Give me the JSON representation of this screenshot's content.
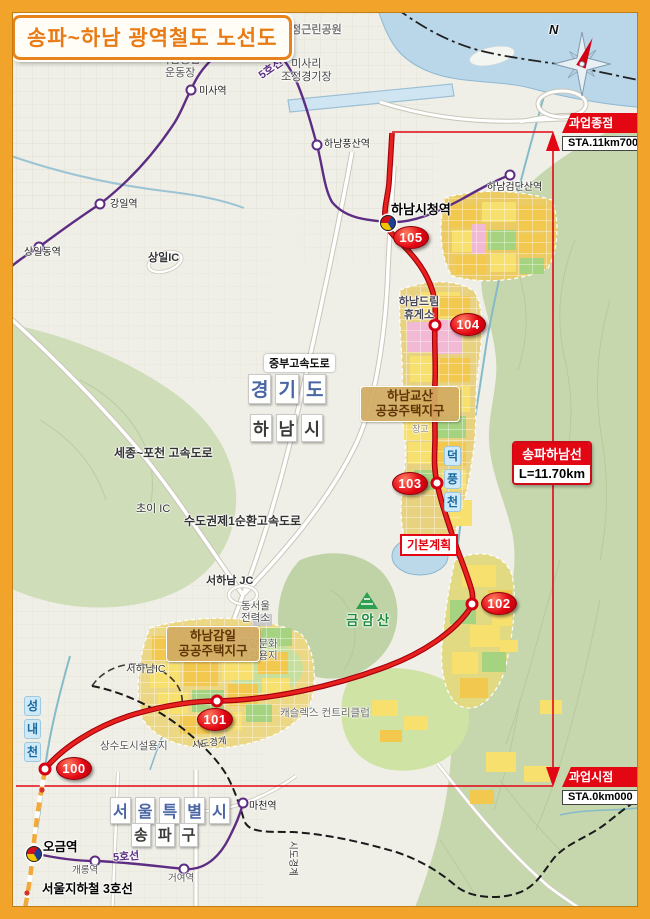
{
  "title": "송파~하남 광역철도 노선도",
  "compass": {
    "north": "N"
  },
  "endpoints": {
    "end": {
      "name": "과업종점",
      "sta": "STA.11km700"
    },
    "start": {
      "name": "과업시점",
      "sta": "STA.0km000"
    }
  },
  "line_info": {
    "name": "송파하남선",
    "length": "L=11.70km"
  },
  "plan_label": "기본계획",
  "route": {
    "stations": [
      {
        "num": "100"
      },
      {
        "num": "101"
      },
      {
        "num": "102"
      },
      {
        "num": "103"
      },
      {
        "num": "104"
      },
      {
        "num": "105"
      }
    ]
  },
  "metro": {
    "ogeum": "오금역",
    "gaerong": "개롱역",
    "geoyeo": "거여역",
    "macheon": "마천역",
    "misa": "미사역",
    "gangil": "강일역",
    "sangildong": "상일동역",
    "pungsan": "하남풍산역",
    "cityhall": "하남시청역",
    "geomdansan": "하남검단산역",
    "line5_top": "5호선",
    "line5_bottom": "5호선",
    "line3": "서울지하철 3호선"
  },
  "regions": {
    "gyeonggi": "경기도",
    "hanam": "하남시",
    "seoul": "서울특별시",
    "songpa": "송파구"
  },
  "roads": {
    "jungbu": "중부고속도로",
    "sejong_pocheon": "세종~포천 고속도로",
    "sudogwon": "수도권제1순환고속도로",
    "choi_ic": "초이 IC",
    "seohanam_jc": "서하남 JC",
    "seohanam_ic": "서하남IC",
    "sangil_ic": "상일IC"
  },
  "zones": {
    "gyosan": "하남교산\n공공주택지구",
    "gamil": "하남감일\n공공주택지구",
    "dream_rest": "하남드림\n휴게소",
    "changgo": "창고",
    "power": "동서울\n전력소",
    "leisure": "휴양문화\n시설용지",
    "castlex": "캐슬렉스 컨트리클럽",
    "waterworks": "상수도시설용지"
  },
  "parks": {
    "dangjeong": "당정근린공원",
    "sports": "하남종합\n운동장",
    "misari": "미사리\n조정경기장"
  },
  "nature": {
    "geumamsan": "금암산",
    "deokpung": "덕풍천",
    "seongnae": "성내천"
  },
  "boundary": {
    "sido1": "시도경계",
    "sido2": "시도경계"
  },
  "colors": {
    "route_red": "#e30613",
    "line5_purple": "#5c2d82",
    "line3_orange": "#f2a93b",
    "frame_orange": "#f2a42a"
  }
}
